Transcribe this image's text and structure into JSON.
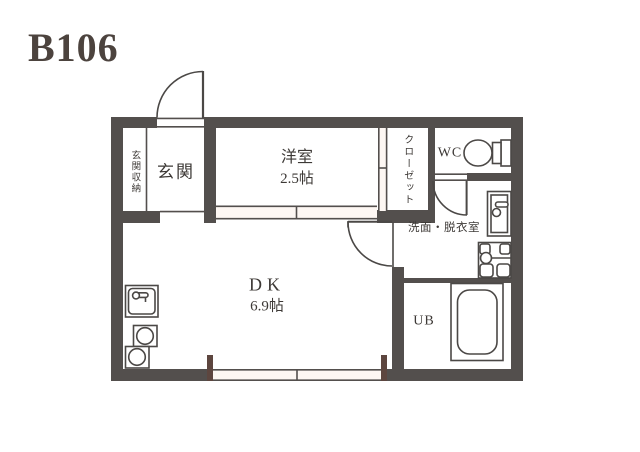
{
  "title": "B106",
  "rooms": {
    "entrance_storage": {
      "label": "玄関収納"
    },
    "entrance": {
      "label": "玄関"
    },
    "western_room": {
      "label": "洋室",
      "area": "2.5帖"
    },
    "closet": {
      "label": "クローゼット"
    },
    "wc": {
      "label": "WC"
    },
    "washroom": {
      "label": "洗面・脱衣室"
    },
    "dining_kitchen": {
      "label": "DK",
      "area": "6.9帖"
    },
    "unit_bath": {
      "label": "UB"
    }
  },
  "colors": {
    "wall": "#534f4d",
    "fixture_line": "#4b4846",
    "label_text": "#3d3936",
    "title_text": "#4c433e",
    "window_post": "#5d463f",
    "opening_fill": "#fdf7f3"
  },
  "icons": {
    "toilet": "toilet-icon",
    "bathtub": "bathtub-icon",
    "kitchen_sink": "kitchen-sink-icon",
    "stove_burners": "stove-burners-icon",
    "washbasin": "washbasin-icon",
    "washing_machine_pan": "washing-machine-pan-icon"
  }
}
